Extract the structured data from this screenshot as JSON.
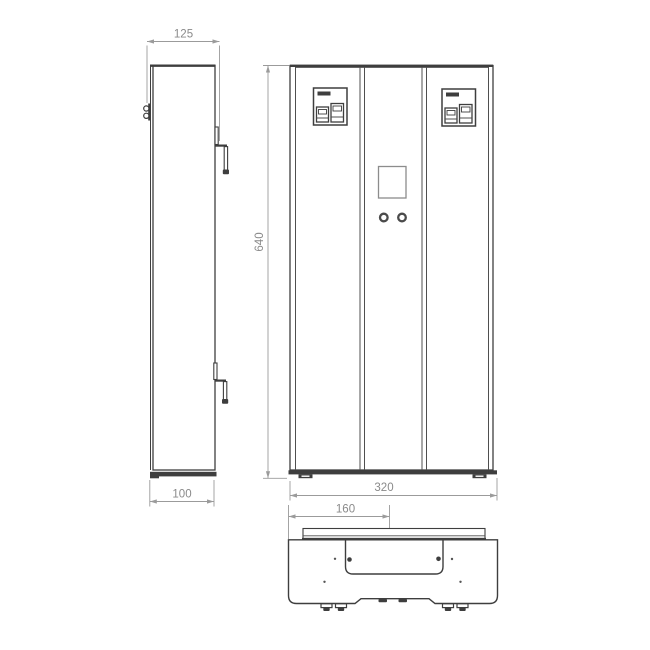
{
  "dimensions": {
    "side_depth_overall": "125",
    "height": "640",
    "side_depth_body": "100",
    "front_width": "320",
    "front_width_half": "160"
  },
  "colors": {
    "outline": "#3e3e3e",
    "panel_line": "#4f4f4f",
    "dim_line": "#9b9b9b",
    "dim_text": "#8a8a8a",
    "display_border": "#8c8c8c",
    "background": "#ffffff"
  }
}
